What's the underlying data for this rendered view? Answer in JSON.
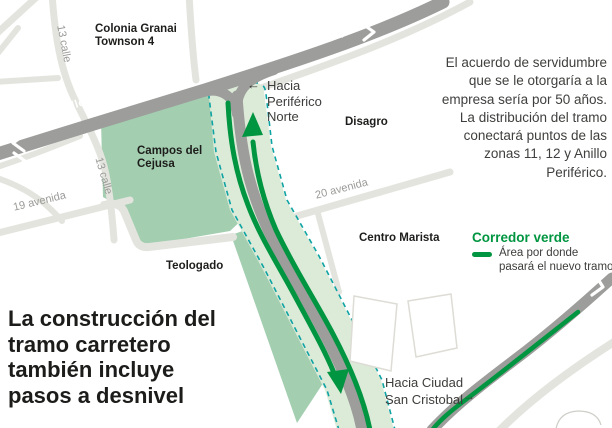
{
  "map": {
    "region_labels": {
      "colonia_line1": "Colonia Granai",
      "colonia_line2": "Townson 4",
      "campos_line1": "Campos del",
      "campos_line2": "Cejusa",
      "disagro": "Disagro",
      "teologado": "Teologado",
      "centro_marista": "Centro Marista"
    },
    "road_labels": {
      "anillo_periferico_left": "Anillo Periférico",
      "anillo_periferico_right": "Anillo Periférico",
      "calle13_top": "13 calle",
      "calle13_bottom": "13 calle",
      "avenida19": "19 avenida",
      "avenida20": "20 avenida"
    },
    "direction_labels": {
      "hacia_periferico_arrow": "←",
      "hacia_periferico_line1": "Hacia",
      "hacia_periferico_line2": "Periférico",
      "hacia_periferico_line3": "Norte",
      "hacia_ciudad_line1": "Hacia Ciudad",
      "hacia_ciudad_line2": "San Cristobal",
      "hacia_ciudad_arrow": "→"
    }
  },
  "headline": {
    "line1": "La construcción del",
    "line2": "tramo carretero",
    "line3": "también incluye",
    "line4": "pasos a desnivel"
  },
  "annotation": {
    "line1": "El acuerdo de servidumbre",
    "line2": "que se le otorgaría a la",
    "line3": "empresa sería por 50 años.",
    "line4": "La distribución del tramo",
    "line5": "conectará puntos de las",
    "line6": "zonas 11, 12 y Anillo",
    "line7": "Periférico."
  },
  "legend": {
    "title": "Corredor verde",
    "item_line1": "Área por donde",
    "item_line2": "pasará el nuevo tramo"
  },
  "colors": {
    "dark_road": "#9d9d9b",
    "light_road": "#e4e4df",
    "green_area": "#a3ceb0",
    "pale_corridor": "#dcead8",
    "green_line": "#009540",
    "teal_dashed": "#0ea3a3",
    "gray_label": "#9a9a98",
    "text_dark": "#1d1d1b"
  }
}
